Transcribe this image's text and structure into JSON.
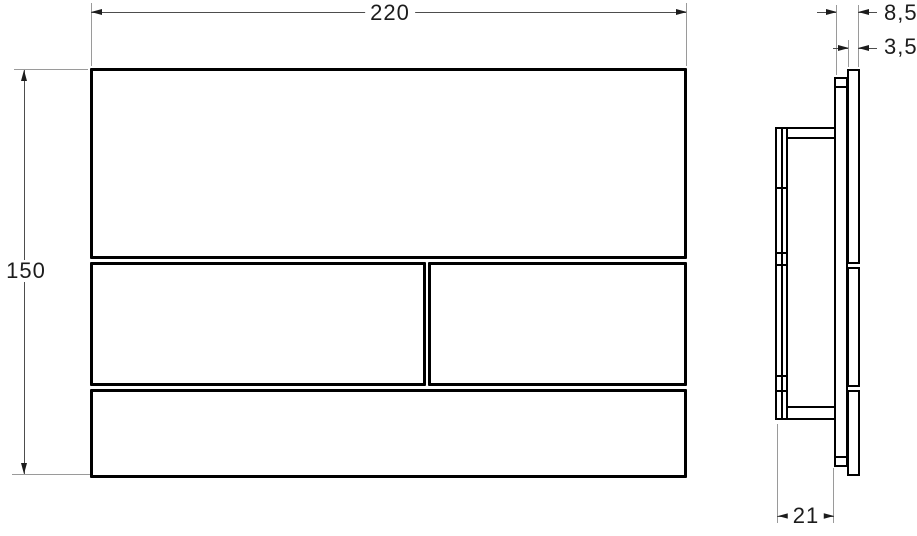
{
  "drawing": {
    "colors": {
      "outline": "#000000",
      "dimension_line": "#4d4d4d",
      "extension_line": "#9a9a9a",
      "text": "#1c1c1c"
    },
    "front_view": {
      "width_label": "220",
      "height_label": "150"
    },
    "side_view": {
      "overall_depth_label": "8,5",
      "plate_thickness_label": "3,5",
      "frame_depth_label": "21"
    }
  }
}
